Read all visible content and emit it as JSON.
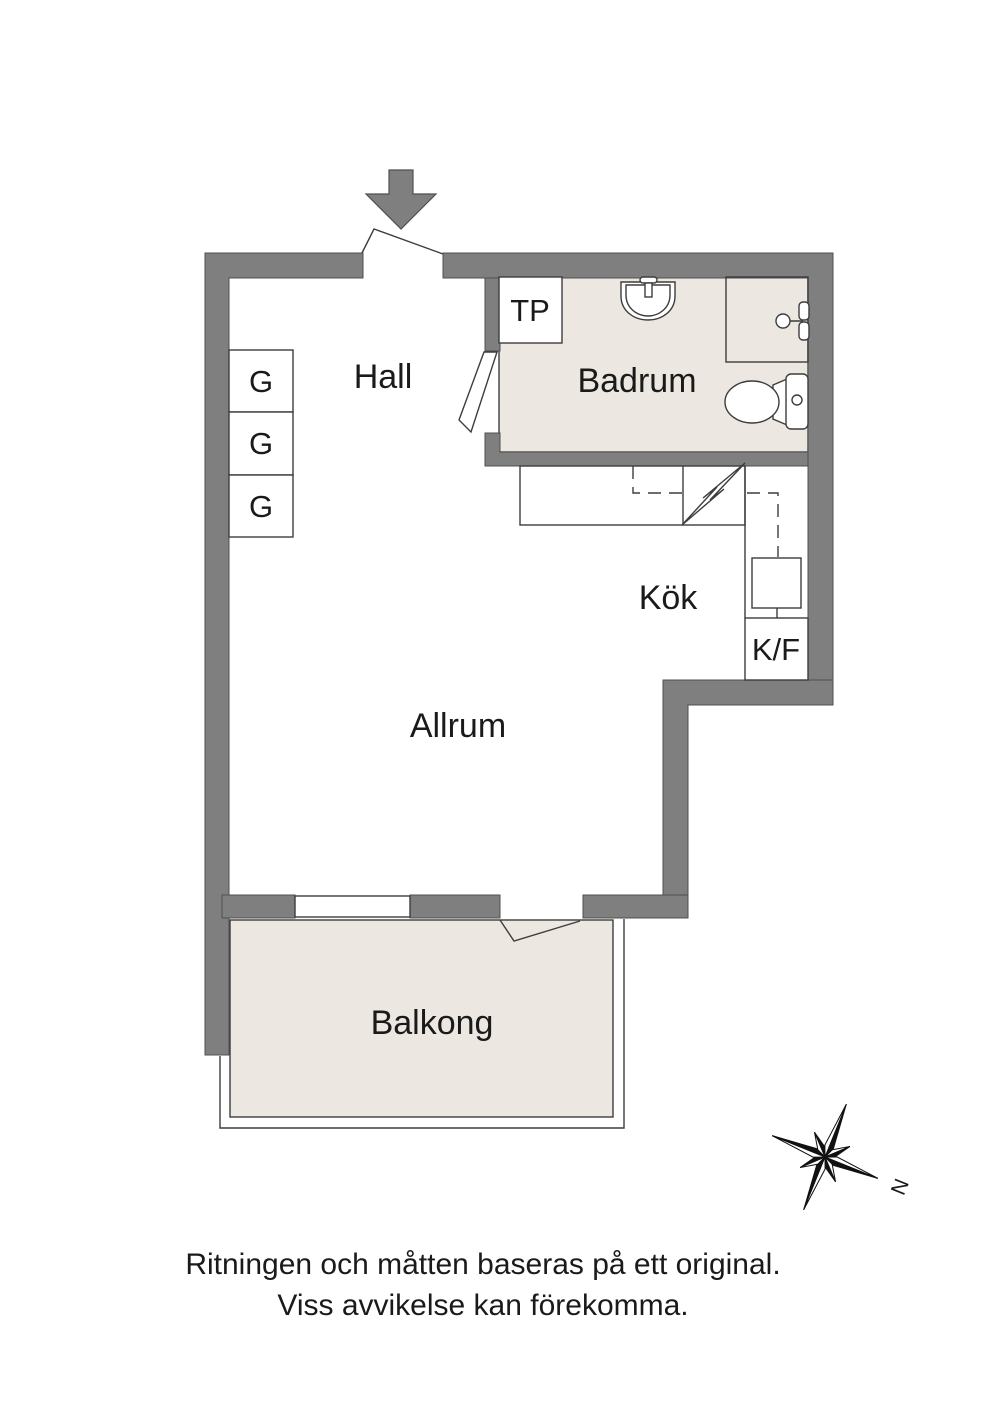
{
  "plan": {
    "rooms": {
      "hall": "Hall",
      "badrum": "Badrum",
      "kok": "Kök",
      "allrum": "Allrum",
      "balkong": "Balkong"
    },
    "fixtures": {
      "tp": "TP",
      "kf": "K/F",
      "wardrobes": [
        "G",
        "G",
        "G"
      ]
    },
    "compass": {
      "north": "N"
    },
    "colors": {
      "wall": "#7f7f7f",
      "wall_outline": "#4f4f4f",
      "floor_accent": "#ece7e1",
      "line": "#3d3d3d",
      "text": "#1a1a1a",
      "background": "#ffffff"
    }
  },
  "footer": {
    "line1": "Ritningen och måtten baseras på ett original.",
    "line2": "Viss avvikelse kan förekomma."
  }
}
